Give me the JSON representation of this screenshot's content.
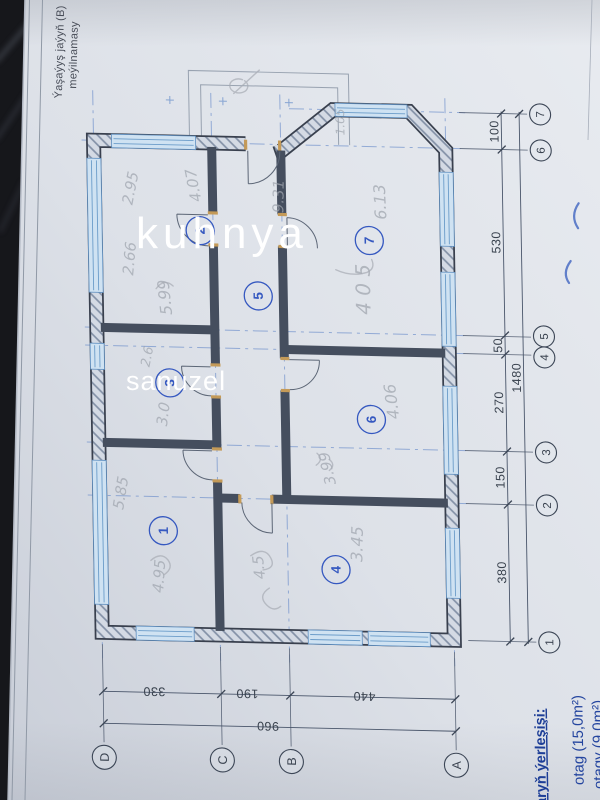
{
  "sheet": {
    "title_line1": "Ýaşaýyş jaýyň (B)",
    "title_line2": "meýilnamasy"
  },
  "overlay": {
    "kitchen_label": "kuhnya",
    "bath_label": "sanuzel"
  },
  "plan": {
    "rooms": {
      "r1": "1",
      "r2": "2",
      "r3": "3",
      "r4": "4",
      "r5": "5",
      "r6": "6",
      "r7": "7"
    },
    "grid_rows": [
      "7",
      "6",
      "5",
      "4",
      "3",
      "2",
      "1"
    ],
    "grid_cols": [
      "D",
      "C",
      "B",
      "A"
    ],
    "dims_right": [
      "100",
      "530",
      "50",
      "270",
      "150",
      "380"
    ],
    "dim_right_total": "1480",
    "dims_bottom": [
      "330",
      "190",
      "440"
    ],
    "dim_bottom_total": "960",
    "annotations": [
      "2.95",
      "4.07",
      "2.66",
      "5.99",
      "9.31",
      "6.13",
      "4 0 5",
      "4.06",
      "3.99",
      "3.45",
      "5.85",
      "4.95",
      "3.0",
      "2.6",
      "1.05",
      "4.5"
    ]
  },
  "notes": {
    "heading": "aryň ýerleşişi:",
    "item1": "otag (15,0m²)",
    "item2": "otagy (9,0m²)"
  },
  "colors": {
    "accent_blue": "#3558c0",
    "axis_blue": "#7191cc",
    "ink": "#39404e",
    "paper": "#dde1e8",
    "pencil": "#9fa5ae",
    "notes_blue": "#1d3e97",
    "window_blue": "#cfe2f2",
    "jamb_tan": "#c49a58"
  }
}
